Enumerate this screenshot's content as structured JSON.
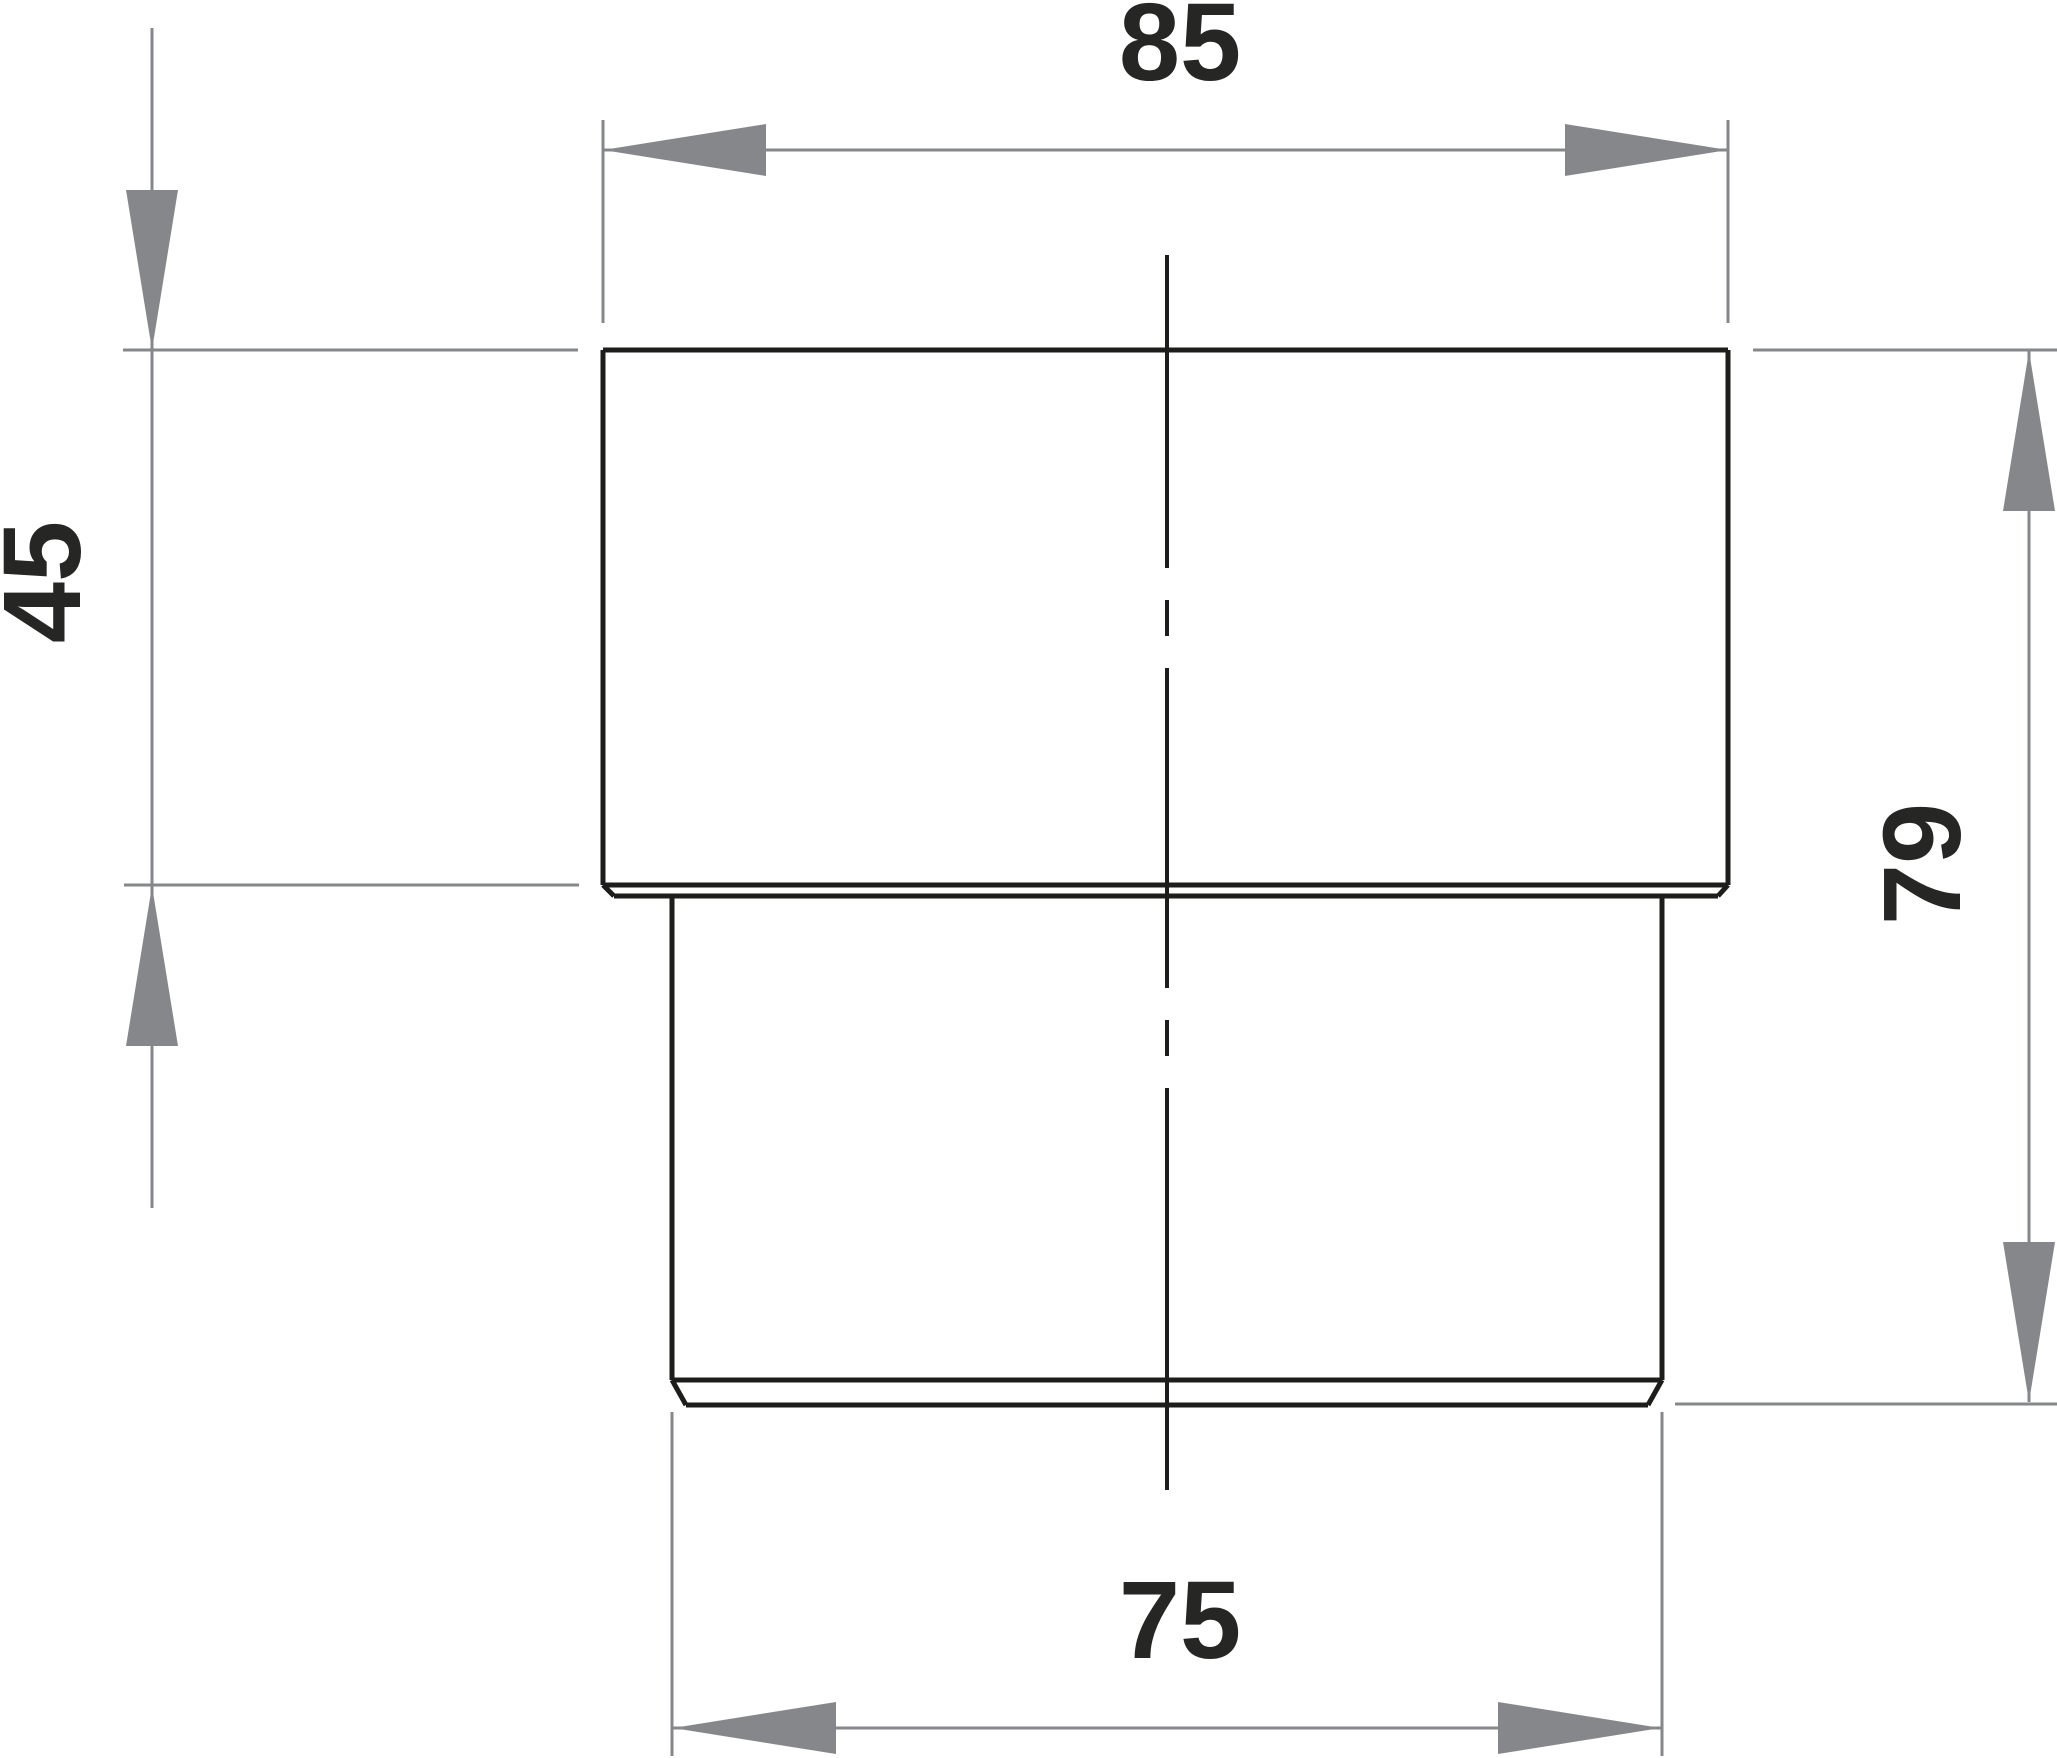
{
  "drawing": {
    "type": "technical-dimension-drawing",
    "units_shown": false,
    "dimensions": {
      "top_width": {
        "label": "85",
        "orientation": "horizontal",
        "position": "top"
      },
      "left_height": {
        "label": "45",
        "orientation": "vertical",
        "position": "left"
      },
      "right_height": {
        "label": "79",
        "orientation": "vertical",
        "position": "right"
      },
      "bottom_width": {
        "label": "75",
        "orientation": "horizontal",
        "position": "bottom"
      }
    },
    "colors": {
      "background": "#ffffff",
      "part_outline": "#1d1d1b",
      "centerline": "#1d1d1b",
      "dimension_lines": "#85878a",
      "dimension_text": "#262624"
    }
  }
}
